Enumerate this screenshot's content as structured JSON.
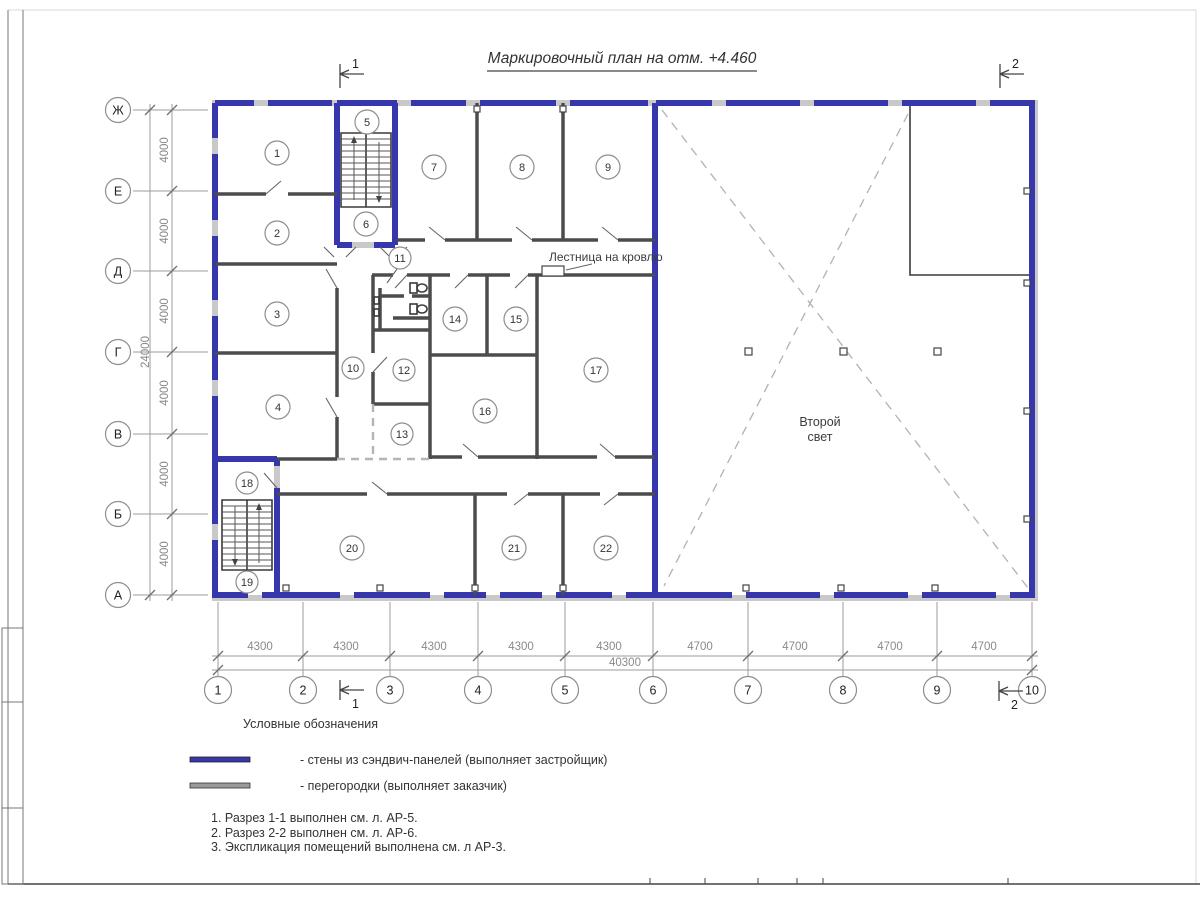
{
  "title": "Маркировочный план на отм. +4.460",
  "labels": {
    "stairs_roof": "Лестница на кровлю",
    "second_light_line1": "Второй",
    "second_light_line2": "свет"
  },
  "rooms": [
    "1",
    "2",
    "3",
    "4",
    "5",
    "6",
    "7",
    "8",
    "9",
    "10",
    "11",
    "12",
    "13",
    "14",
    "15",
    "16",
    "17",
    "18",
    "19",
    "20",
    "21",
    "22"
  ],
  "axes": {
    "letters": [
      "Ж",
      "Е",
      "Д",
      "Г",
      "В",
      "Б",
      "А"
    ],
    "numbers": [
      "1",
      "2",
      "3",
      "4",
      "5",
      "6",
      "7",
      "8",
      "9",
      "10"
    ]
  },
  "dimensions": {
    "left_segments": [
      "4000",
      "4000",
      "4000",
      "4000",
      "4000",
      "4000"
    ],
    "left_total": "24000",
    "bottom_segments": [
      "4300",
      "4300",
      "4300",
      "4300",
      "4300",
      "4700",
      "4700",
      "4700",
      "4700"
    ],
    "bottom_total": "40300"
  },
  "sections": {
    "one": "1",
    "two": "2"
  },
  "legend": {
    "heading": "Условные обозначения",
    "item1": "- стены из сэндвич-панелей (выполняет застройщик)",
    "item2": "- перегородки (выполняет заказчик)",
    "wall_color": "#3636ad",
    "partition_color": "#9a9a9a"
  },
  "notes": [
    "1. Разрез 1-1 выполнен см. л. АР-5.",
    "2. Разрез 2-2 выполнен см. л. АР-6.",
    "3. Экспликация помещений выполнена см. л АР-3."
  ]
}
